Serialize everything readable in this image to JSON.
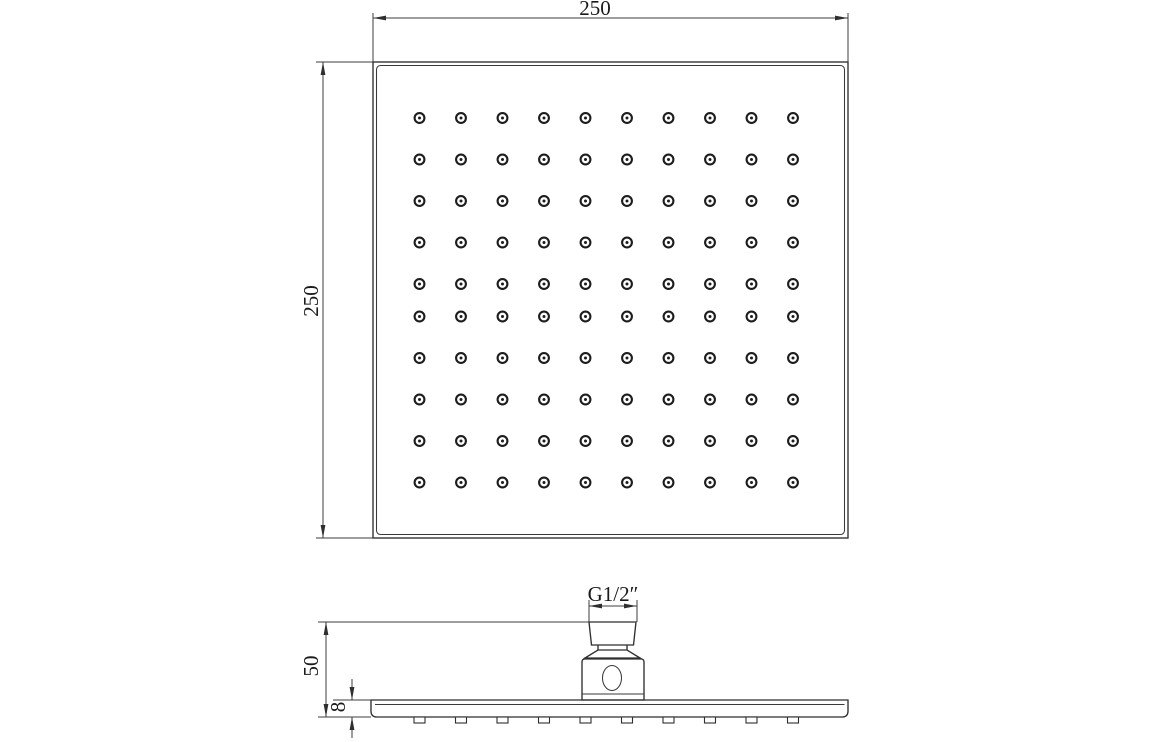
{
  "style": {
    "background": "#ffffff",
    "outline_color": "#2f2f2f",
    "dim_color": "#3c3c3c",
    "text_color": "#1a1a1a"
  },
  "labels": {
    "top_width": "250",
    "left_height": "250",
    "side_height": "50",
    "plate_thickness": "8",
    "thread_size": "G1/2″"
  },
  "top_view": {
    "outer_square": {
      "x": 373,
      "y": 62,
      "width": 475,
      "height": 476
    },
    "inner_square": {
      "x": 376.5,
      "y": 65.5,
      "width": 468,
      "height": 469,
      "corner_radius": 4
    },
    "nozzle_grid": {
      "columns_x": [
        419.5,
        461,
        502.5,
        544,
        585.5,
        627,
        668.5,
        710,
        751.5,
        793
      ],
      "rows_y": [
        118,
        159.5,
        201,
        242.5,
        284,
        316.5,
        358,
        399.5,
        441,
        482.5
      ],
      "outer_radius": 4.9,
      "dot_radius": 1.5
    },
    "dims": {
      "width": {
        "label_key": "top_width",
        "line_y": 18,
        "from_x": 373,
        "to_x": 848,
        "ext_y_top": 13,
        "text": {
          "x": 595,
          "y": 15,
          "rotate": 0
        }
      },
      "height": {
        "label_key": "left_height",
        "line_x": 323,
        "from_y": 62,
        "to_y": 538,
        "ext_x_left": 316,
        "text": {
          "x": 318,
          "y": 301,
          "rotate": -90
        }
      }
    }
  },
  "side_view": {
    "plate": {
      "x1": 371,
      "x2": 848,
      "top_y": 700,
      "bottom_y": 717,
      "end_corner_radius": 6,
      "face_line_y": 704.5,
      "face_line_x1": 375,
      "face_line_x2": 844.5
    },
    "nozzle_tips": {
      "width": 11,
      "height": 6
    },
    "connector": {
      "pipe": {
        "x1_top": 589,
        "x2_top": 636,
        "x1_bottom": 591.5,
        "x2_bottom": 633.5,
        "y_top": 622,
        "y_bottom": 645
      },
      "neck": {
        "x1": 598,
        "x2": 627,
        "y_top": 645,
        "y_bottom": 650
      },
      "collar": {
        "x1_top": 598,
        "x2_top": 627,
        "x1_bottom": 585,
        "x2_bottom": 640,
        "y_top": 650,
        "y_bottom": 658
      },
      "body": {
        "x1": 582,
        "x2": 644,
        "y_top": 659,
        "y_bottom": 700,
        "corner_radius": 3,
        "flange_line_y": 694
      },
      "inlet_hole": {
        "cx": 612,
        "cy": 678,
        "rx": 9.5,
        "ry": 12.5
      }
    },
    "dims": {
      "thread": {
        "label_key": "thread_size",
        "line_y": 606,
        "from_x": 589,
        "to_x": 637,
        "ext_y_top": 600,
        "ext_y_bottom": 622,
        "text": {
          "x": 613,
          "y": 601,
          "rotate": 0
        }
      },
      "height": {
        "label_key": "side_height",
        "line_x": 326,
        "from_y": 622,
        "to_y": 717,
        "ext_x_left": 318,
        "ext_top_x2": 589,
        "ext_bottom_x2": 371,
        "text": {
          "x": 318,
          "y": 666,
          "rotate": -90
        }
      },
      "thickness": {
        "label_key": "plate_thickness",
        "line_x": 352,
        "from_y": 700,
        "to_y": 717,
        "tail": 21,
        "ext": {
          "y": 700,
          "x1": 333,
          "x2": 371
        },
        "text": {
          "x": 345,
          "y": 707,
          "rotate": -90
        }
      }
    }
  }
}
